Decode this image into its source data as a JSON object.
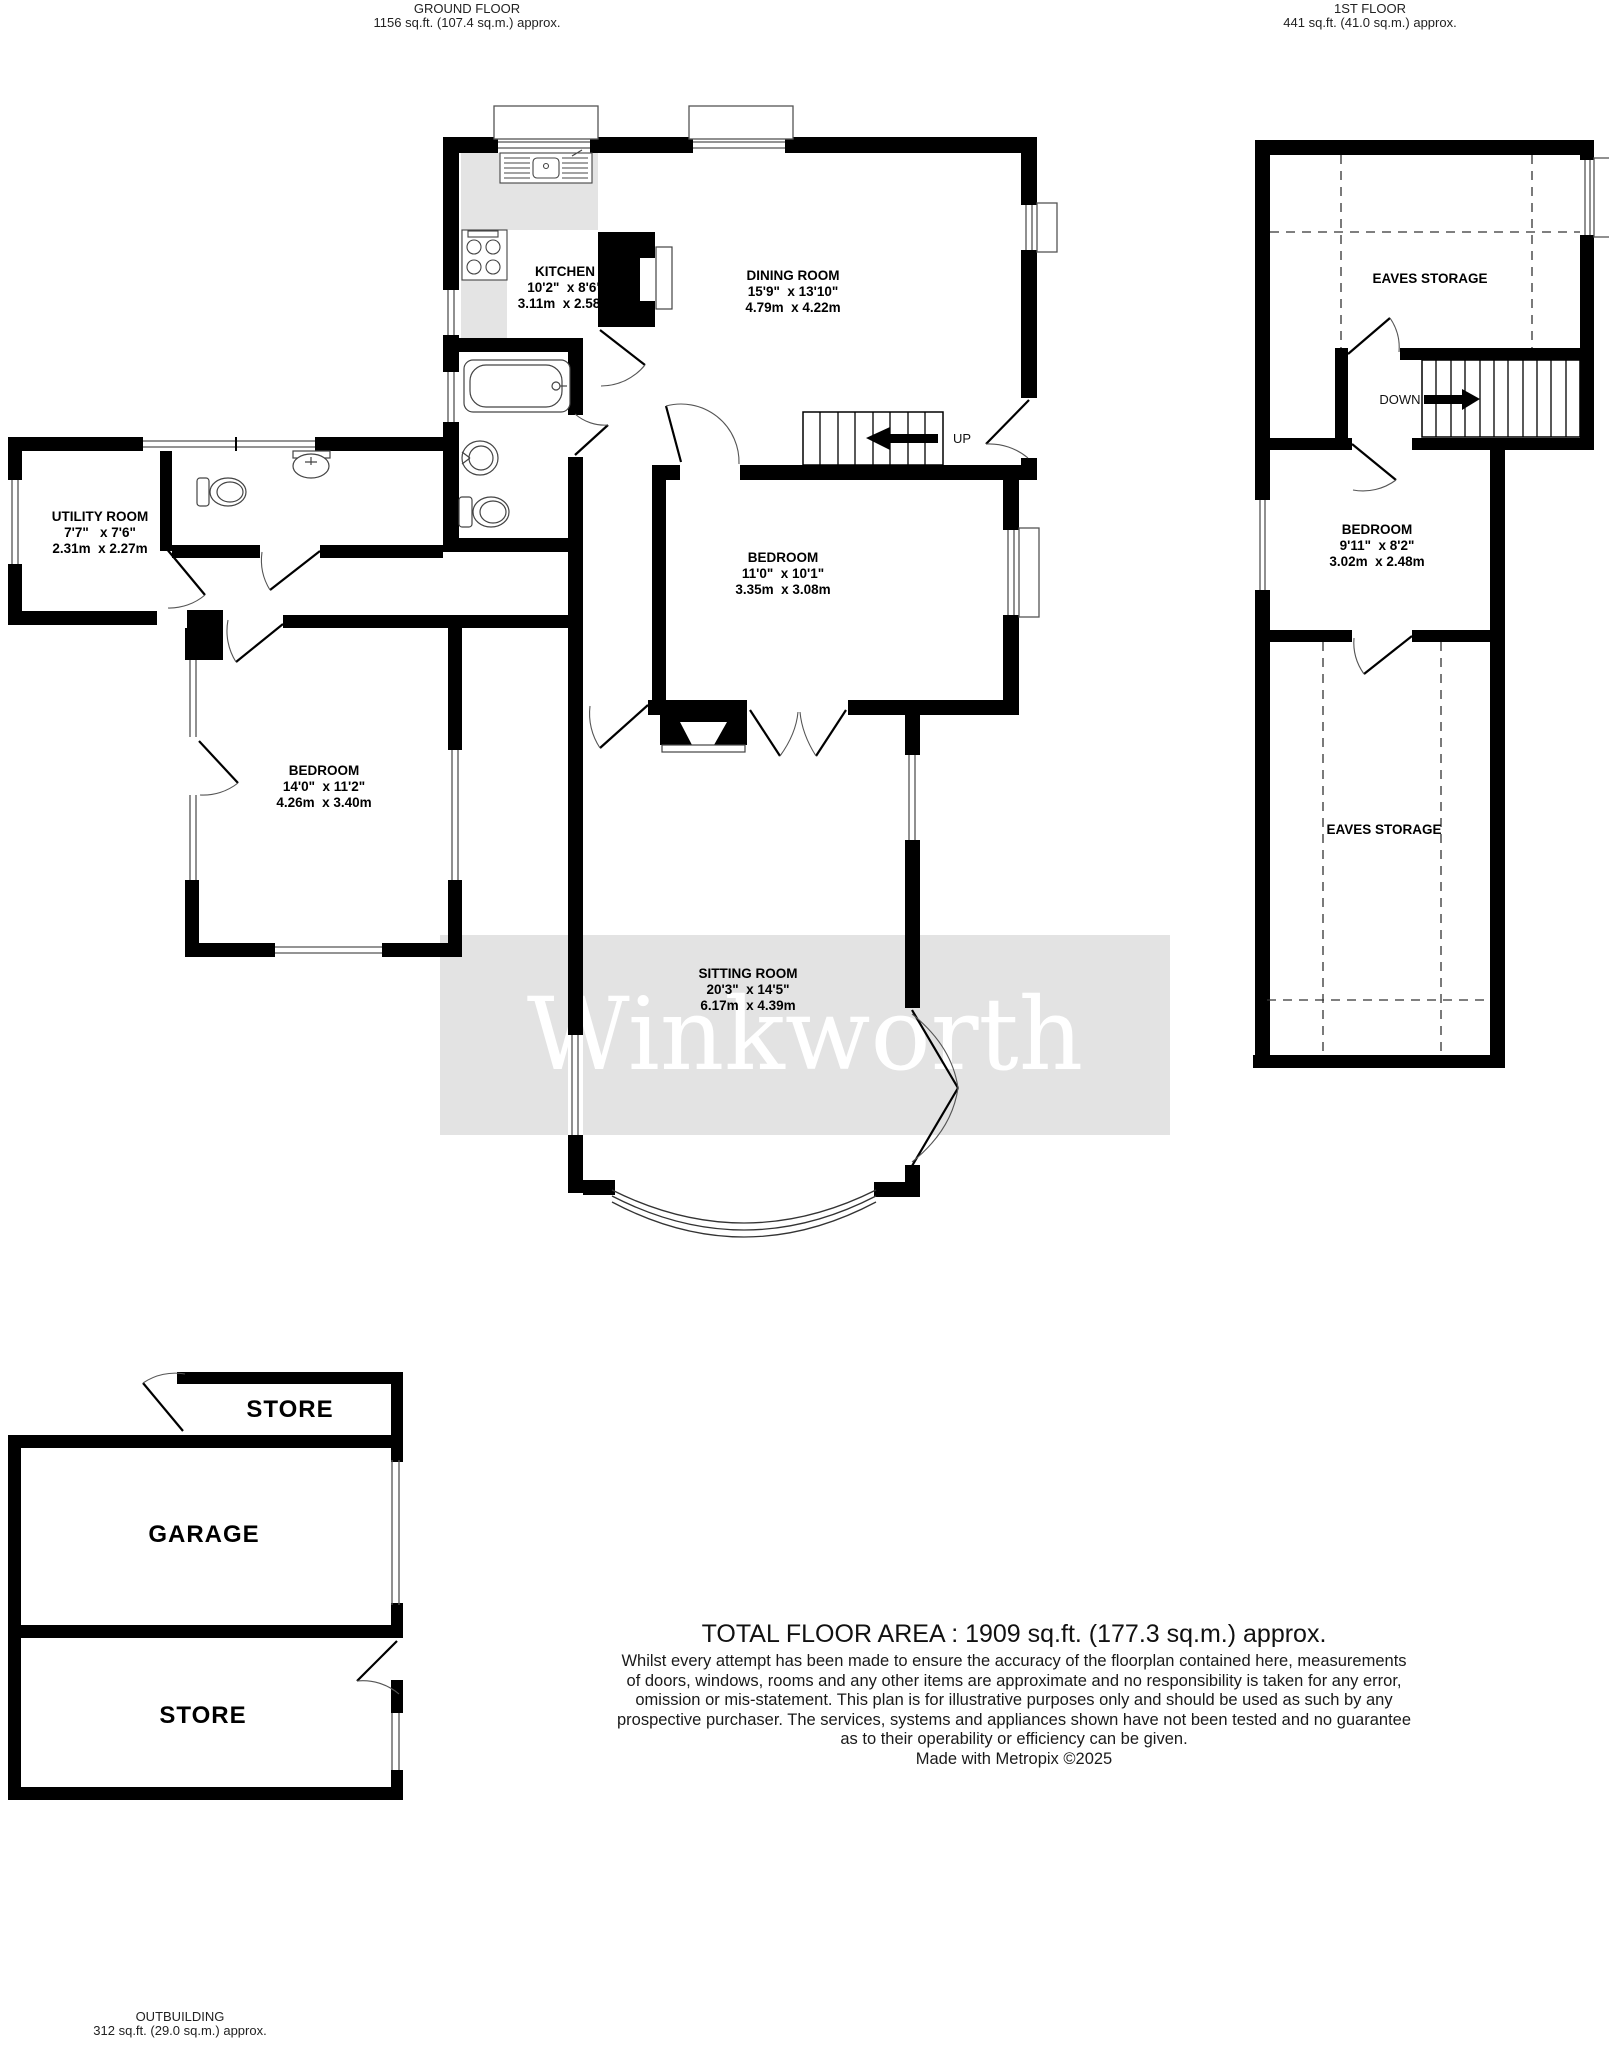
{
  "header": {
    "ground_floor": {
      "title": "GROUND FLOOR",
      "area": "1156 sq.ft. (107.4 sq.m.) approx."
    },
    "first_floor": {
      "title": "1ST FLOOR",
      "area": "441 sq.ft. (41.0 sq.m.) approx."
    }
  },
  "watermark": {
    "text": "Winkworth",
    "band_color": "#e3e3e3",
    "text_color": "#ffffff"
  },
  "colors": {
    "wall": "#000000",
    "fixture_line": "#444444",
    "counter_gray": "#e4e4e4"
  },
  "rooms": {
    "kitchen": {
      "name": "KITCHEN",
      "imperial": "10'2\"  x 8'6\"",
      "metric": "3.11m  x 2.58m"
    },
    "dining_room": {
      "name": "DINING ROOM",
      "imperial": "15'9\"  x 13'10\"",
      "metric": "4.79m  x 4.22m"
    },
    "utility_room": {
      "name": "UTILITY ROOM",
      "imperial": "7'7\"   x 7'6\"",
      "metric": "2.31m  x 2.27m"
    },
    "bedroom_middle": {
      "name": "BEDROOM",
      "imperial": "11'0\"  x 10'1\"",
      "metric": "3.35m  x 3.08m"
    },
    "bedroom_left": {
      "name": "BEDROOM",
      "imperial": "14'0\"  x 11'2\"",
      "metric": "4.26m  x 3.40m"
    },
    "sitting_room": {
      "name": "SITTING ROOM",
      "imperial": "20'3\"  x 14'5\"",
      "metric": "6.17m  x 4.39m"
    },
    "bedroom_first": {
      "name": "BEDROOM",
      "imperial": "9'11\"  x 8'2\"",
      "metric": "3.02m  x 2.48m"
    },
    "eaves_storage_top": {
      "name": "EAVES STORAGE"
    },
    "eaves_storage_bottom": {
      "name": "EAVES STORAGE"
    },
    "store_top": {
      "name": "STORE"
    },
    "garage": {
      "name": "GARAGE"
    },
    "store_bottom": {
      "name": "STORE"
    }
  },
  "stairs": {
    "up_label": "UP",
    "down_label": "DOWN"
  },
  "footer": {
    "total": "TOTAL FLOOR AREA : 1909 sq.ft. (177.3 sq.m.) approx.",
    "disclaimer_lines": [
      "Whilst every attempt has been made to ensure the accuracy of the floorplan contained here, measurements",
      "of doors, windows, rooms and any other items are approximate and no responsibility is taken for any error,",
      "omission or mis-statement. This plan is for illustrative purposes only and should be used as such by any",
      "prospective purchaser. The services, systems and appliances shown have not been tested and no guarantee",
      "as to their operability or efficiency can be given.",
      "Made with Metropix ©2025"
    ],
    "outbuilding": {
      "title": "OUTBUILDING",
      "area": "312 sq.ft. (29.0 sq.m.) approx."
    }
  }
}
